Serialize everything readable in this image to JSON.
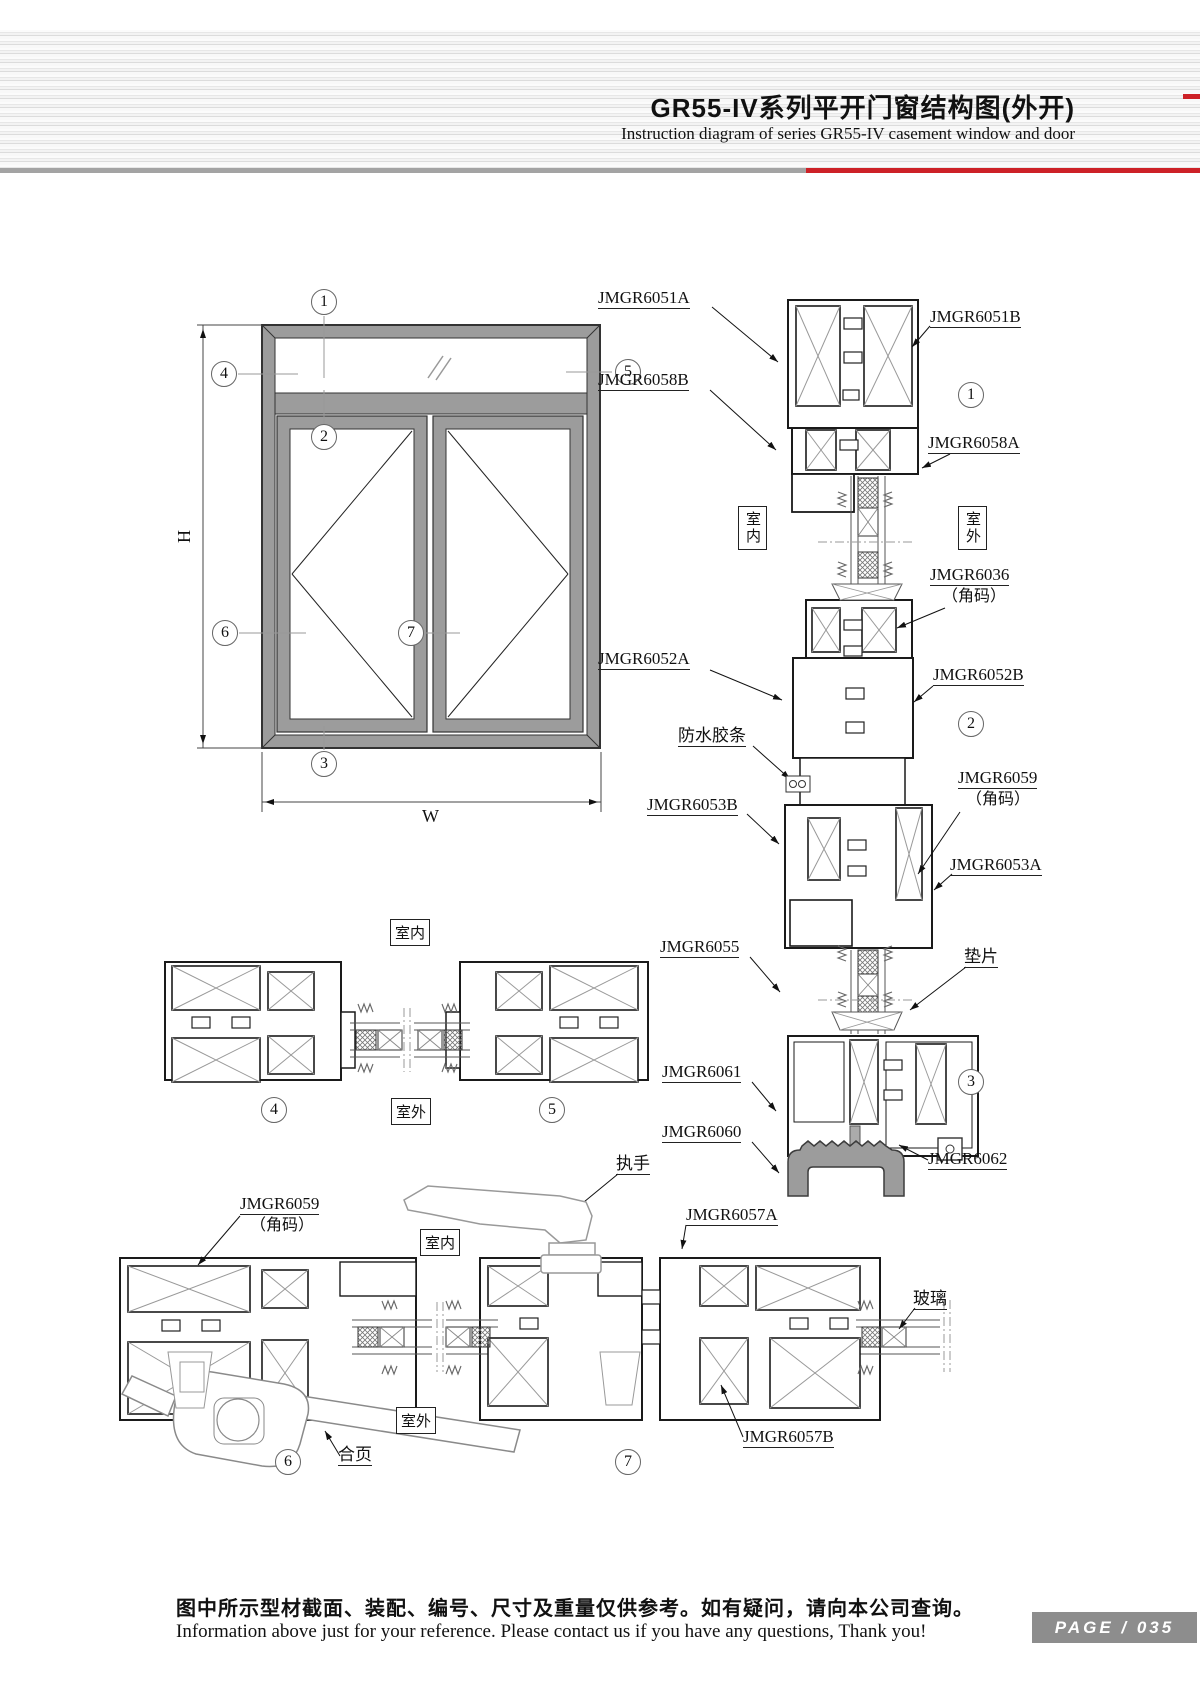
{
  "header": {
    "title": "GR55-IV系列平开门窗结构图(外开)",
    "subtitle": "Instruction diagram of series GR55-IV casement window and door"
  },
  "colors": {
    "accent_red": "#cd2127",
    "rule_grey": "#a3a3a3",
    "badge_grey": "#8d8d8d",
    "frame_grey": "#9c9c9c"
  },
  "elevation": {
    "dim_h": "H",
    "dim_w": "W"
  },
  "callouts": {
    "c1": "1",
    "c2": "2",
    "c3": "3",
    "c4": "4",
    "c5": "5",
    "c6": "6",
    "c7": "7"
  },
  "rooms": {
    "indoor": "室内",
    "outdoor": "室外"
  },
  "parts": {
    "jmgr6051a": "JMGR6051A",
    "jmgr6051b": "JMGR6051B",
    "jmgr6058b": "JMGR6058B",
    "jmgr6058a": "JMGR6058A",
    "jmgr6036": "JMGR6036",
    "jiaoma": "（角码）",
    "jmgr6052a": "JMGR6052A",
    "jmgr6052b": "JMGR6052B",
    "waterproof_strip": "防水胶条",
    "jmgr6053b": "JMGR6053B",
    "jmgr6059": "JMGR6059",
    "jmgr6053a": "JMGR6053A",
    "jmgr6055": "JMGR6055",
    "shim": "垫片",
    "jmgr6061": "JMGR6061",
    "jmgr6060": "JMGR6060",
    "jmgr6062": "JMGR6062",
    "handle": "执手",
    "jmgr6057a": "JMGR6057A",
    "jmgr6057b": "JMGR6057B",
    "glass": "玻璃",
    "hinge": "合页"
  },
  "footer": {
    "note_zh": "图中所示型材截面、装配、编号、尺寸及重量仅供参考。如有疑问，请向本公司查询。",
    "note_en": "Information above just for your reference. Please contact us if you have any questions, Thank you!",
    "page_label": "PAGE / 035"
  }
}
